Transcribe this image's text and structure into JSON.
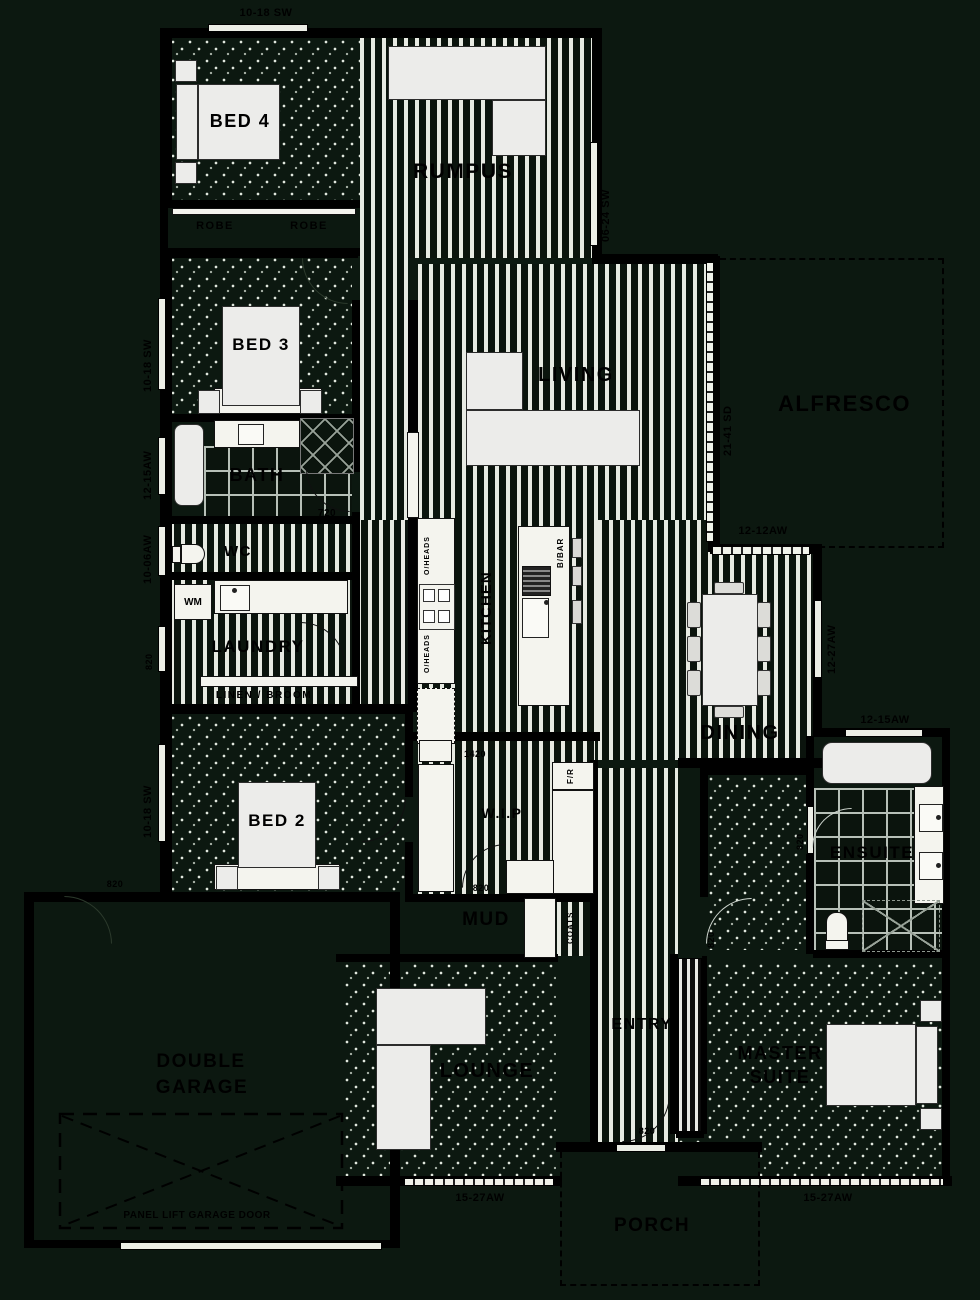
{
  "plan": {
    "rooms": {
      "bed4": "BED 4",
      "bed3": "BED 3",
      "bed2": "BED 2",
      "master_line1": "MASTER",
      "master_line2": "SUITE",
      "rumpus": "RUMPUS",
      "living": "LIVING",
      "lounge": "LOUNGE",
      "dining": "DINING",
      "kitchen": "KITCHEN",
      "alfresco": "ALFRESCO",
      "porch": "PORCH",
      "entry": "ENTRY",
      "mud": "MUD",
      "wip": "W.I.P",
      "bath": "BATH",
      "wc": "WC",
      "ensuite": "ENSUITE",
      "laundry": "LAUNDRY",
      "garage_line1": "DOUBLE",
      "garage_line2": "GARAGE",
      "robe_left": "ROBE",
      "robe_right": "ROBE",
      "linen": "LINEN / BROOM",
      "coats": "COATS"
    },
    "fixtures": {
      "wm": "WM",
      "bbar": "B/BAR",
      "oheads_upper": "O/HEADS",
      "oheads_lower": "O/HEADS",
      "fridge": "F/R",
      "garage_door": "PANEL LIFT GARAGE DOOR"
    },
    "dims": {
      "bed4_window": "10-18 SW",
      "rumpus_window": "06-24 SW",
      "bed3_window": "10-18 SW",
      "bath_window": "12-15AW",
      "wc_window": "10-06AW",
      "laundry_door": "820",
      "bed2_window": "10-18 SW",
      "bath_door": "720",
      "alfresco_stacker": "21-41 SD",
      "alfresco_window": "12-12AW",
      "dining_window": "12-27AW",
      "ensuite_window": "12-15AW",
      "ensuite_door": "820",
      "master_door": "820",
      "wip_door": "820",
      "wip_bench": "1420",
      "entry_door": "820",
      "garage_door_int": "820",
      "lounge_window": "15-27AW",
      "master_window": "15-27AW"
    }
  }
}
